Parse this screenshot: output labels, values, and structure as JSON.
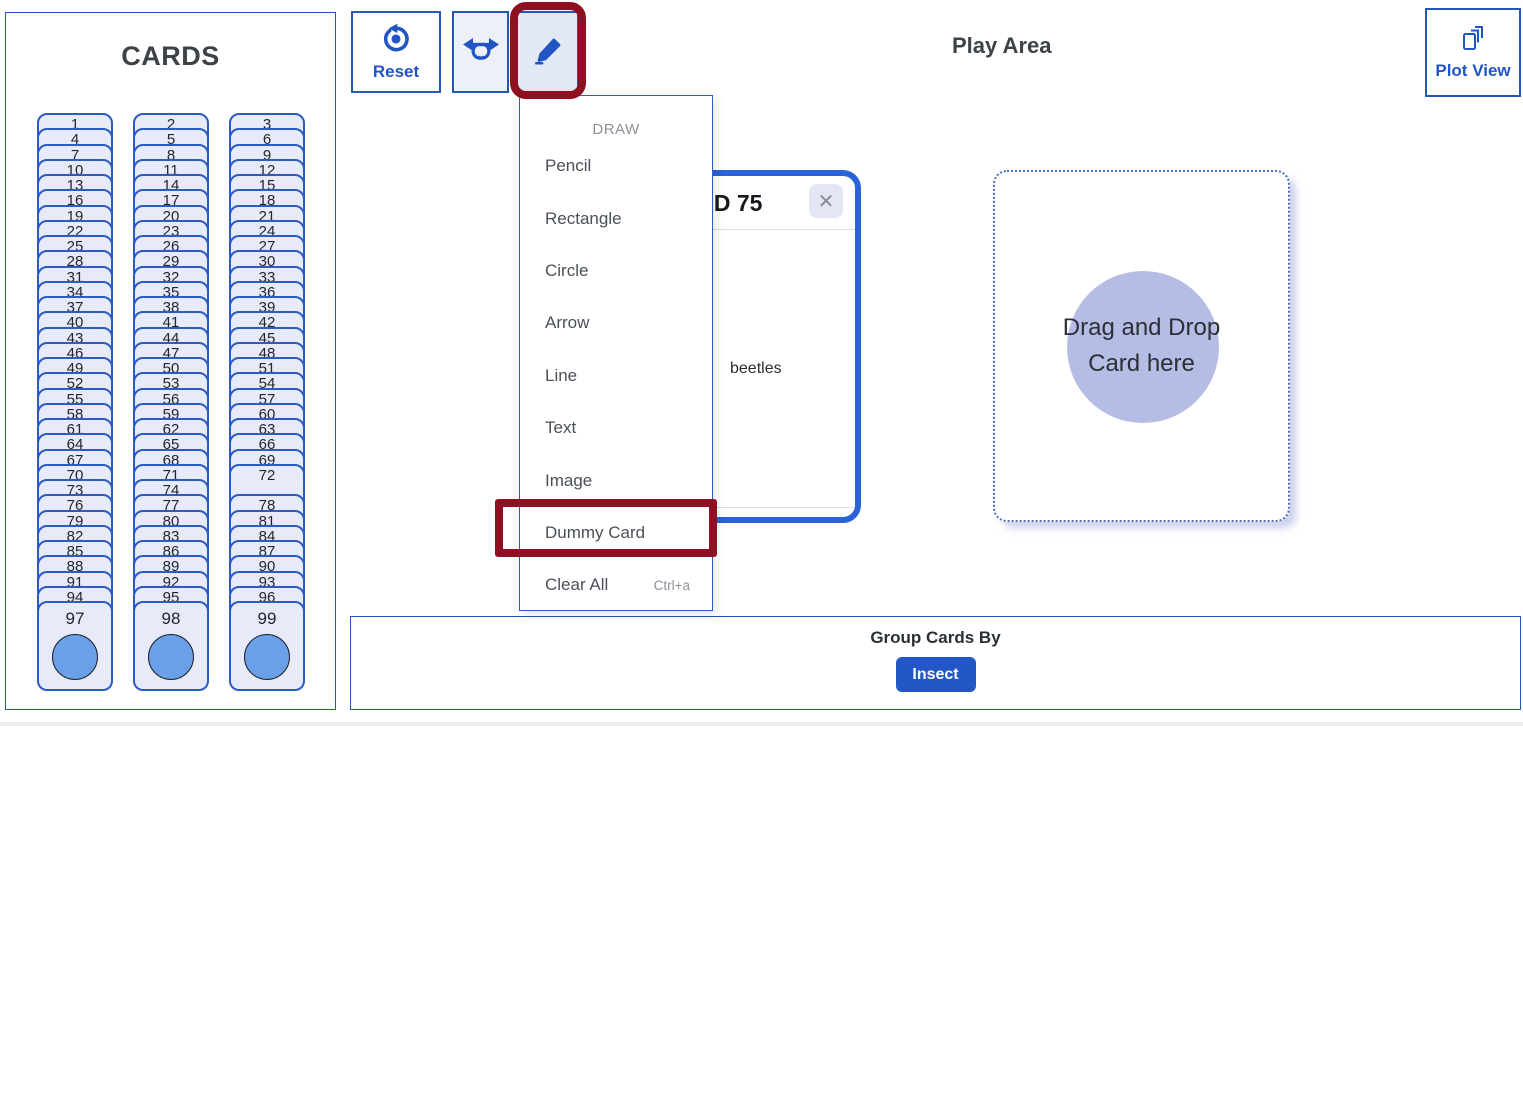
{
  "colors": {
    "primary_blue": "#2155c4",
    "border_blue": "#2456b8",
    "card_fill": "#e7eaf8",
    "card_border": "#2d5cc0",
    "circle_blue": "#69a0e8",
    "play_card_border": "#2a62d9",
    "lavender_circle": "#b5bde5",
    "annotation_red": "#8e1021",
    "menu_text": "#4b5058",
    "muted_gray": "#8d929a"
  },
  "cards_panel": {
    "title": "CARDS",
    "columns": [
      {
        "numbers": [
          1,
          4,
          7,
          10,
          13,
          16,
          19,
          22,
          25,
          28,
          31,
          34,
          37,
          40,
          43,
          46,
          49,
          52,
          55,
          58,
          61,
          64,
          67,
          70,
          73,
          76,
          79,
          82,
          85,
          88,
          91,
          94,
          97
        ],
        "gap_slots": []
      },
      {
        "numbers": [
          2,
          5,
          8,
          11,
          14,
          17,
          20,
          23,
          26,
          29,
          32,
          35,
          38,
          41,
          44,
          47,
          50,
          53,
          56,
          59,
          62,
          65,
          68,
          71,
          74,
          77,
          80,
          83,
          86,
          89,
          92,
          95,
          98
        ],
        "gap_slots": []
      },
      {
        "numbers": [
          3,
          6,
          9,
          12,
          15,
          18,
          21,
          24,
          27,
          30,
          33,
          36,
          39,
          42,
          45,
          48,
          51,
          54,
          57,
          60,
          63,
          66,
          69,
          72,
          78,
          81,
          84,
          87,
          90,
          93,
          96,
          99
        ],
        "gap_slots": [
          24
        ]
      }
    ],
    "exposed_card": "72",
    "bottom_cards": [
      "97",
      "98",
      "99"
    ]
  },
  "toolbar": {
    "reset_label": "Reset",
    "icons": {
      "reset": "reset-circular-arrow-icon",
      "shuffle": "shuffle-arrows-icon",
      "draw": "pencil-icon"
    }
  },
  "dropdown": {
    "header": "DRAW",
    "items": [
      {
        "label": "Pencil"
      },
      {
        "label": "Rectangle"
      },
      {
        "label": "Circle"
      },
      {
        "label": "Arrow"
      },
      {
        "label": "Line"
      },
      {
        "label": "Text"
      },
      {
        "label": "Image"
      },
      {
        "label": "Dummy Card"
      },
      {
        "label": "Clear All",
        "shortcut": "Ctrl+a"
      }
    ]
  },
  "annotations": [
    {
      "target": "draw-button",
      "color": "#8e1021"
    },
    {
      "target": "menu-item-dummy-card",
      "color": "#8e1021"
    }
  ],
  "play_area": {
    "title": "Play Area"
  },
  "play_card": {
    "title": "CARD 75",
    "body_text": "beetles",
    "close_glyph": "✕"
  },
  "drop_zone": {
    "line1": "Drag and Drop",
    "line2": "Card here"
  },
  "group_bar": {
    "label": "Group Cards By",
    "button_label": "Insect"
  },
  "plot_view": {
    "label": "Plot View",
    "icon": "stacked-cards-icon"
  }
}
